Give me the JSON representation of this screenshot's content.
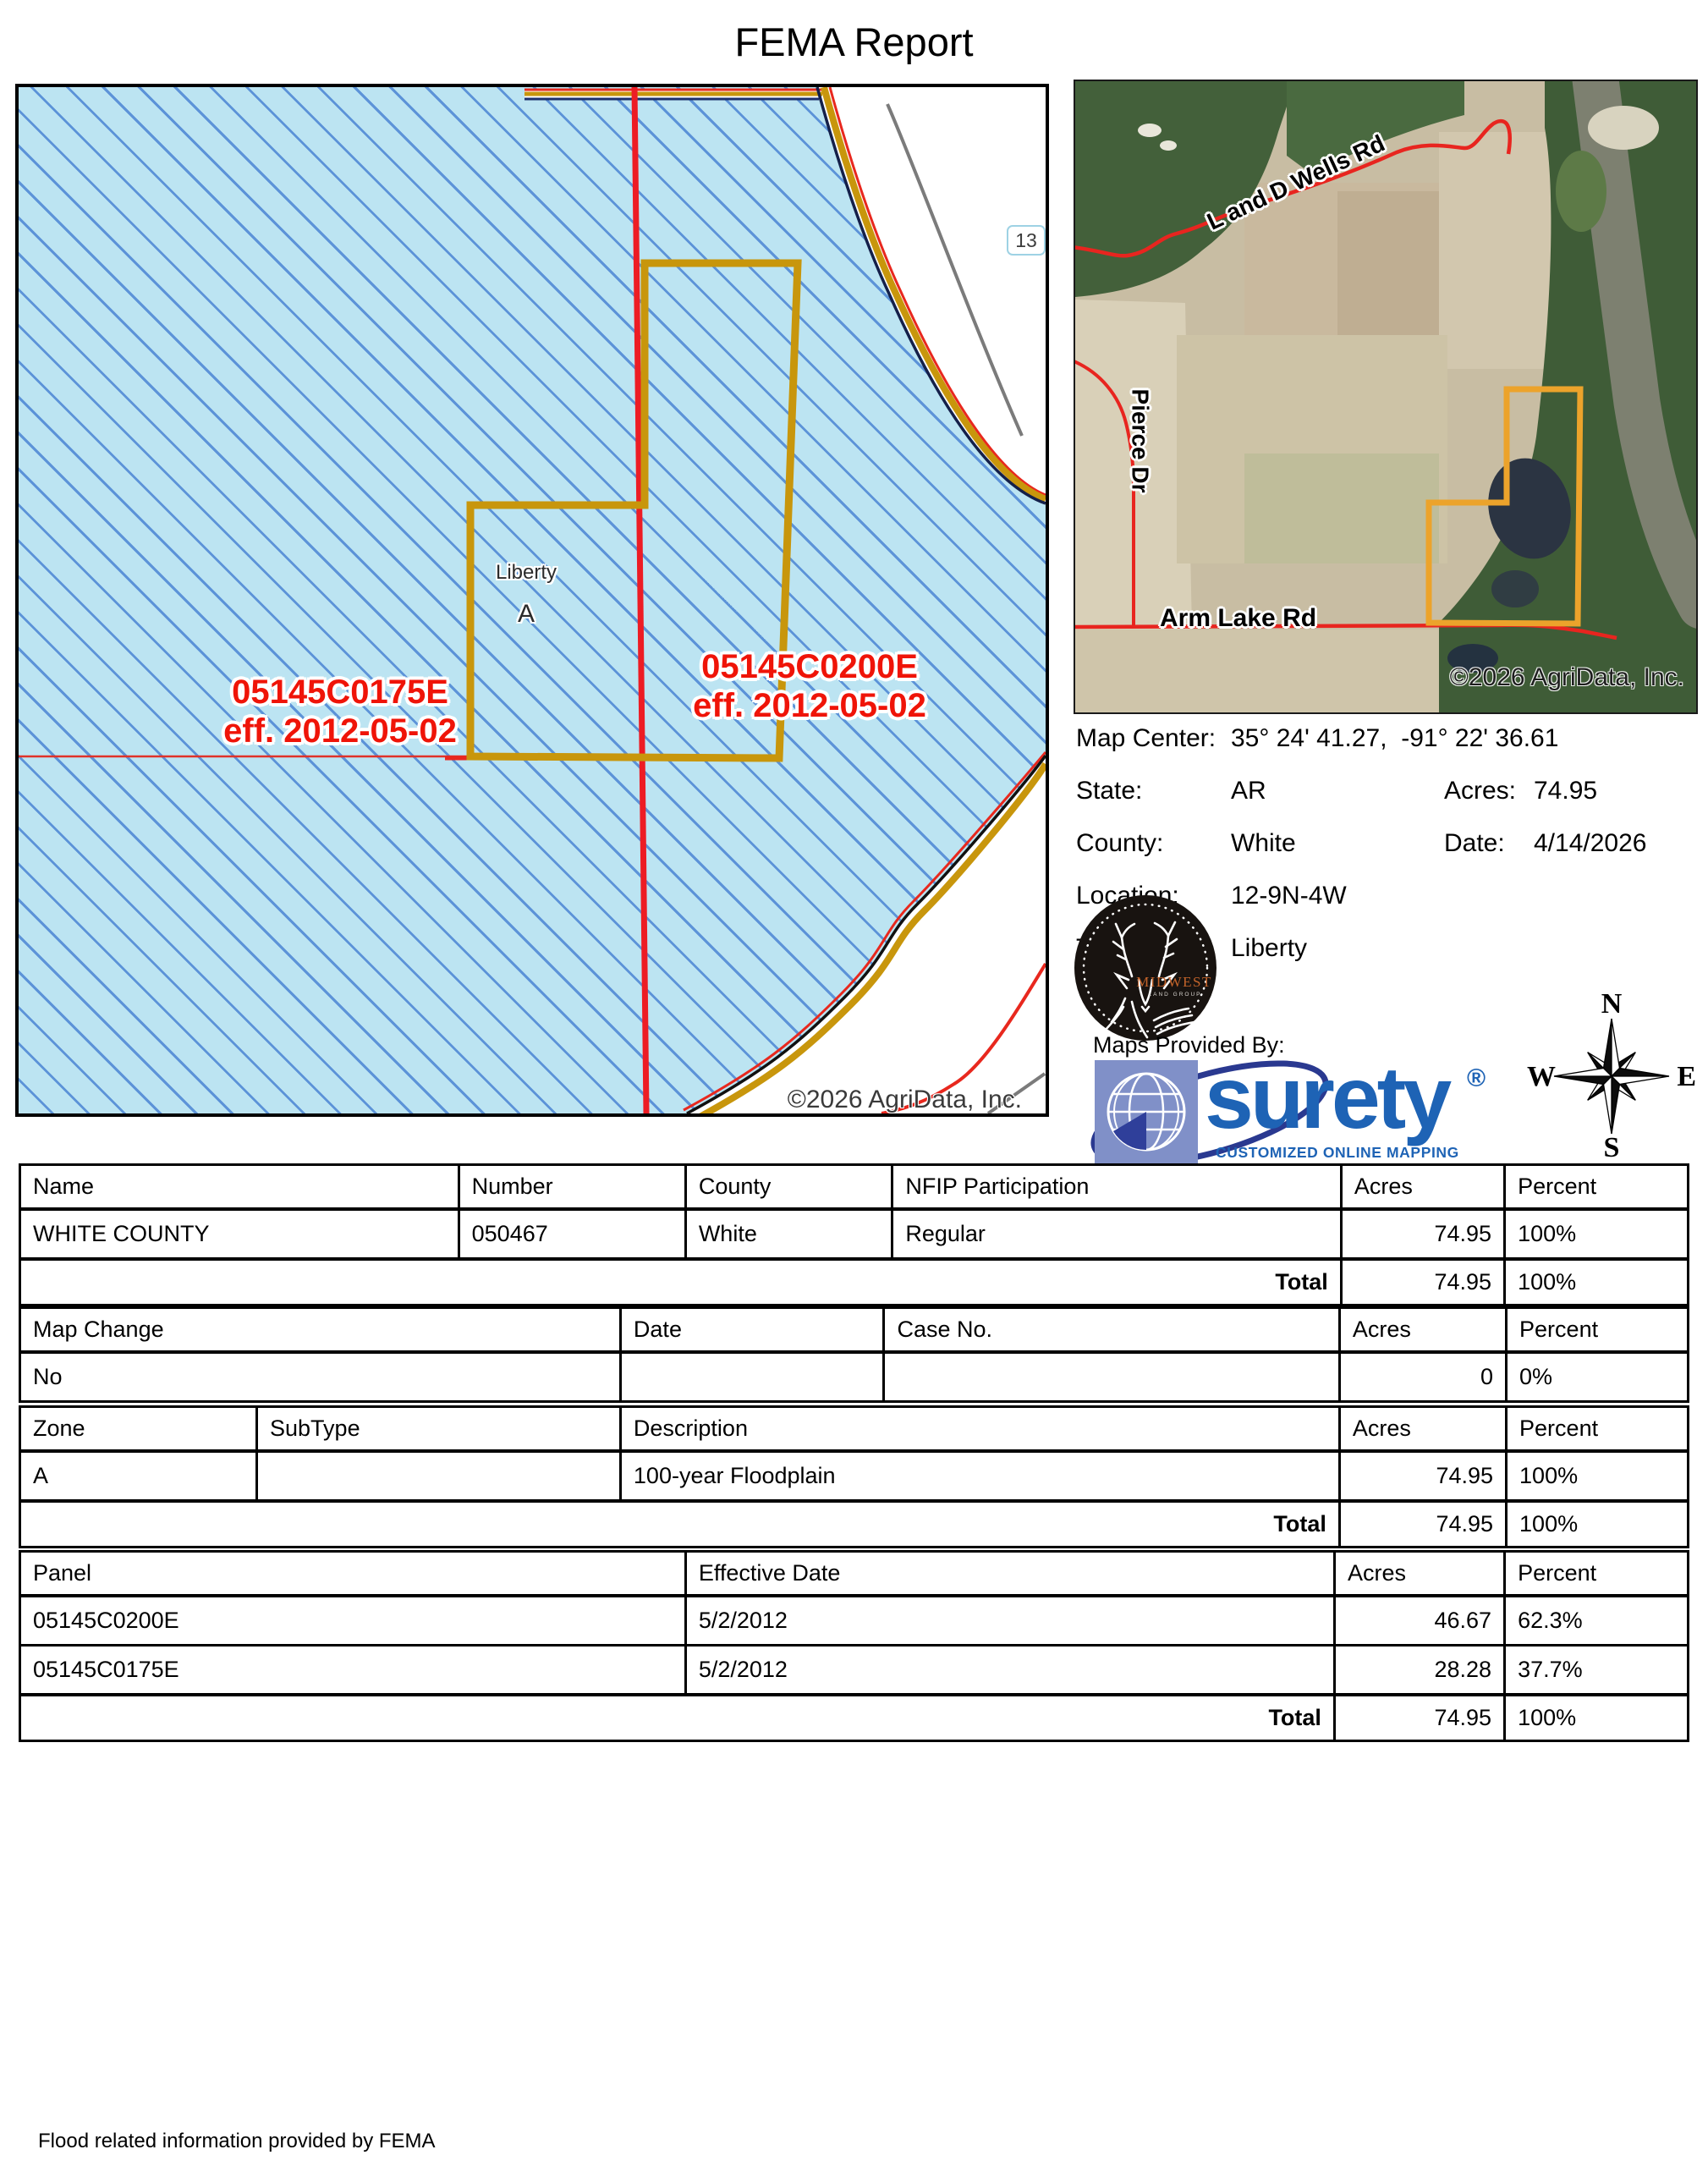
{
  "title": "FEMA Report",
  "flood_map": {
    "label_left_line1": "05145C0175E",
    "label_left_line2": "eff. 2012-05-02",
    "label_right_line1": "05145C0200E",
    "label_right_line2": "eff. 2012-05-02",
    "township_label": "Liberty",
    "zone_label": "A",
    "section_number": "13",
    "copyright": "©2026 AgriData, Inc."
  },
  "aerial_map": {
    "road_top": "L and D Wells Rd",
    "road_left": "Pierce Dr",
    "road_bottom": "Arm Lake Rd",
    "copyright": "©2026 AgriData, Inc."
  },
  "info": {
    "map_center_label": "Map Center:",
    "map_center_value": "35° 24' 41.27,  -91° 22' 36.61",
    "state_label": "State:",
    "state_value": "AR",
    "acres_label": "Acres:",
    "acres_value": "74.95",
    "county_label": "County:",
    "county_value": "White",
    "date_label": "Date:",
    "date_value": "4/14/2026",
    "location_label": "Location:",
    "location_value": "12-9N-4W",
    "township_label": "Township:",
    "township_value": "Liberty"
  },
  "branding": {
    "midwest_name": "MIDWEST",
    "midwest_sub": "LAND GROUP",
    "maps_provided_by": "Maps Provided By:",
    "surety_name": "surety",
    "surety_reg": "®",
    "surety_tagline": "CUSTOMIZED ONLINE MAPPING",
    "agridata_copyright": "© AgriData, Inc. 2025",
    "agridata_url": "www.AgriDataInc.com"
  },
  "compass": {
    "n": "N",
    "e": "E",
    "s": "S",
    "w": "W"
  },
  "tables": {
    "county": {
      "headers": [
        "Name",
        "Number",
        "County",
        "NFIP Participation",
        "Acres",
        "Percent"
      ],
      "rows": [
        [
          "WHITE COUNTY",
          "050467",
          "White",
          "Regular",
          "74.95",
          "100%"
        ]
      ],
      "total_label": "Total",
      "total_acres": "74.95",
      "total_percent": "100%"
    },
    "map_change": {
      "headers": [
        "Map Change",
        "Date",
        "Case No.",
        "Acres",
        "Percent"
      ],
      "rows": [
        [
          "No",
          "",
          "",
          "0",
          "0%"
        ]
      ]
    },
    "zone": {
      "headers": [
        "Zone",
        "SubType",
        "Description",
        "Acres",
        "Percent"
      ],
      "rows": [
        [
          "A",
          "",
          "100-year Floodplain",
          "74.95",
          "100%"
        ]
      ],
      "total_label": "Total",
      "total_acres": "74.95",
      "total_percent": "100%"
    },
    "panel": {
      "headers": [
        "Panel",
        "Effective Date",
        "Acres",
        "Percent"
      ],
      "rows": [
        [
          "05145C0200E",
          "5/2/2012",
          "46.67",
          "62.3%"
        ],
        [
          "05145C0175E",
          "5/2/2012",
          "28.28",
          "37.7%"
        ]
      ],
      "total_label": "Total",
      "total_acres": "74.95",
      "total_percent": "100%"
    }
  },
  "footer": "Flood related information provided by FEMA",
  "colors": {
    "flood_fill": "#BCE4F2",
    "flood_hatch": "#5C93D8",
    "boundary_gold": "#C8960C",
    "parcel_gold_aerial": "#ECA32B",
    "line_red": "#EC1C24",
    "label_red": "#EF1408",
    "surety_blue": "#1E63B5",
    "midwest_orange": "#C2632A"
  }
}
